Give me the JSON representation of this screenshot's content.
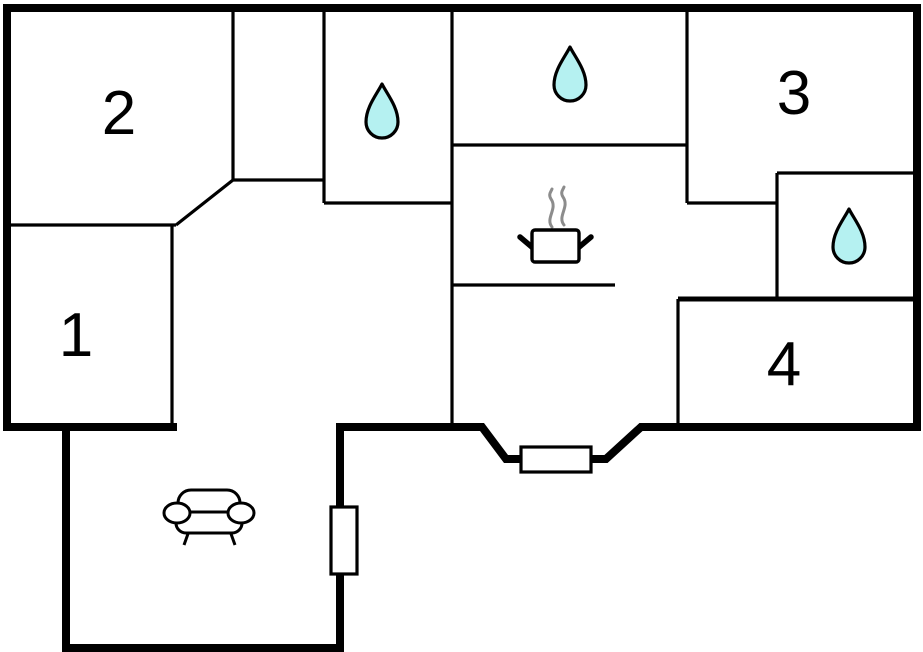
{
  "plan": {
    "type": "floor-plan",
    "rooms": [
      {
        "id": "room-1",
        "number": "1"
      },
      {
        "id": "room-2",
        "number": "2"
      },
      {
        "id": "room-3",
        "number": "3"
      },
      {
        "id": "room-4",
        "number": "4"
      }
    ],
    "icons": {
      "water_drop": {
        "name": "water-drop-icon",
        "count": 3
      },
      "cooking_pot": {
        "name": "cooking-pot-icon",
        "count": 1
      },
      "steam": {
        "name": "steam-icon",
        "count": 1
      },
      "sofa": {
        "name": "sofa-icon",
        "count": 1
      },
      "window": {
        "name": "window-icon",
        "count": 2
      }
    },
    "colors": {
      "wall": "#000000",
      "background": "#ffffff",
      "droplet_fill": "#b5f1f1",
      "droplet_stroke": "#000000",
      "steam": "#8c8c8c",
      "furniture_fill": "#ffffff"
    }
  }
}
